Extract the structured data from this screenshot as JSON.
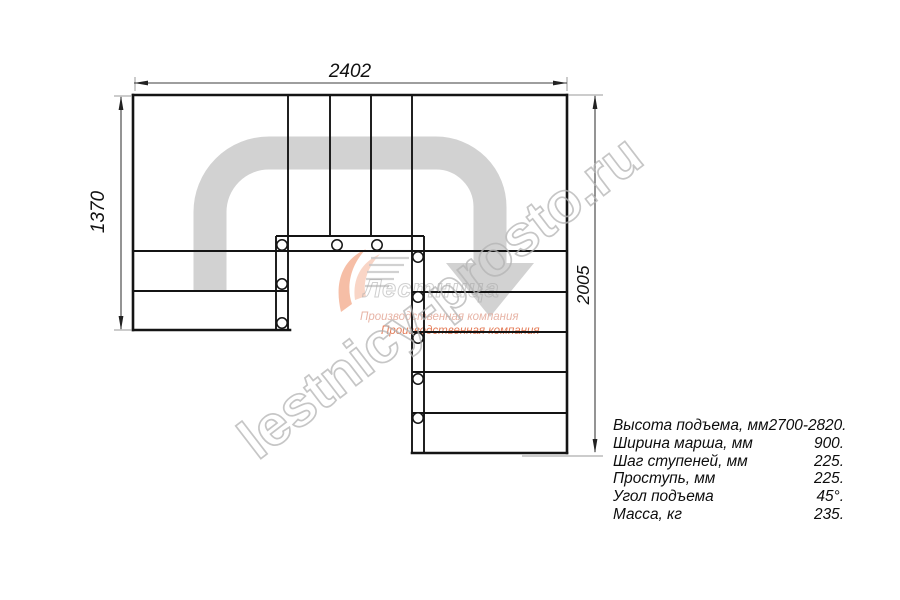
{
  "drawing": {
    "dim_top": "2402",
    "dim_left": "1370",
    "dim_right": "2005"
  },
  "watermark": {
    "site": "lestnicy-prosto.ru",
    "logo_text": "Лестница",
    "logo_subtitle1": "Производственная компания",
    "logo_subtitle2": "Производственная компания"
  },
  "specs": {
    "rows": [
      {
        "label": "Высота подъема, мм",
        "value": "2700-2820."
      },
      {
        "label": "Ширина марша, мм",
        "value": "900."
      },
      {
        "label": "Шаг ступеней, мм",
        "value": "225."
      },
      {
        "label": "Проступь, мм",
        "value": "225."
      },
      {
        "label": "Угол подъема",
        "value": "45°."
      },
      {
        "label": "Масса, кг",
        "value": "235."
      }
    ]
  },
  "colors": {
    "walk_path": "#d2d2d2",
    "logo_orange": "#e0643a",
    "logo_orange_pale": "#e2a291",
    "watermark_grey": "#b4b4b4",
    "line_black": "#141414"
  }
}
